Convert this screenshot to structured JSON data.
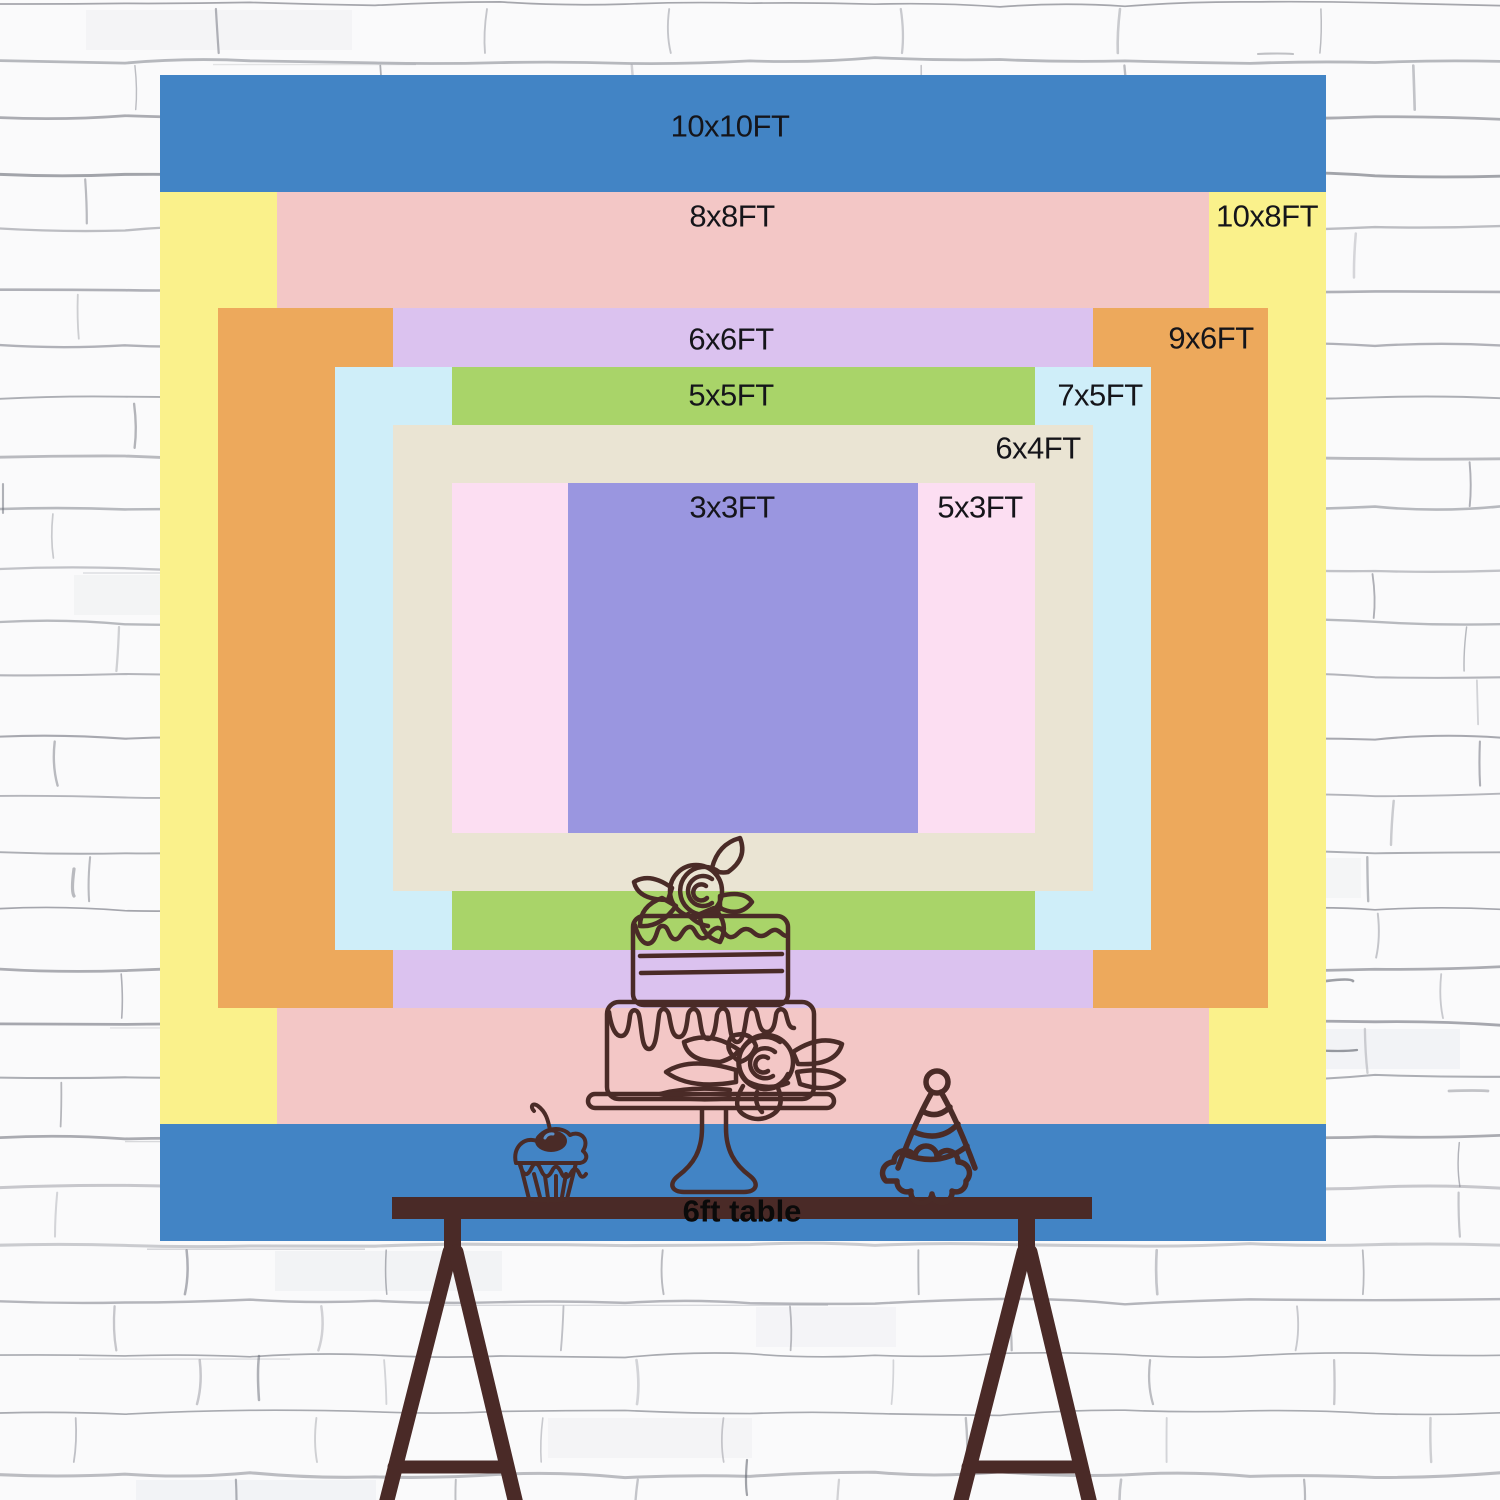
{
  "backdrop_chart": {
    "description_icon": "nested-backdrop-size-rectangles",
    "label_color": "#15151a",
    "sizes": [
      {
        "id": "10x10",
        "label": "10x10FT",
        "width_ft": 10,
        "height_ft": 10,
        "color": "#4284c5"
      },
      {
        "id": "10x8",
        "label": "10x8FT",
        "width_ft": 10,
        "height_ft": 8,
        "color": "#faf18b"
      },
      {
        "id": "8x8",
        "label": "8x8FT",
        "width_ft": 8,
        "height_ft": 8,
        "color": "#f3c7c6"
      },
      {
        "id": "9x6",
        "label": "9x6FT",
        "width_ft": 9,
        "height_ft": 6,
        "color": "#eda95c"
      },
      {
        "id": "6x6",
        "label": "6x6FT",
        "width_ft": 6,
        "height_ft": 6,
        "color": "#dbc2ef"
      },
      {
        "id": "7x5",
        "label": "7x5FT",
        "width_ft": 7,
        "height_ft": 5,
        "color": "#cfeef9"
      },
      {
        "id": "5x5",
        "label": "5x5FT",
        "width_ft": 5,
        "height_ft": 5,
        "color": "#a9d469"
      },
      {
        "id": "6x4",
        "label": "6x4FT",
        "width_ft": 6,
        "height_ft": 4,
        "color": "#eae4d3"
      },
      {
        "id": "5x3",
        "label": "5x3FT",
        "width_ft": 5,
        "height_ft": 3,
        "color": "#fcdef2"
      },
      {
        "id": "3x3",
        "label": "3x3FT",
        "width_ft": 3,
        "height_ft": 3,
        "color": "#9a96e0"
      }
    ]
  },
  "table": {
    "label": "6ft table",
    "length_ft": 6,
    "bar_color": "#4a2a27"
  },
  "illustration": {
    "line_color": "#4a2b27",
    "items": [
      "tiered-cake-icon",
      "rose-icon",
      "cake-stand-icon",
      "cupcake-icon",
      "party-hat-icon",
      "trestle-legs-icon"
    ]
  },
  "wall": {
    "background": "#fafafb",
    "brick_line_color": "#83858e",
    "brick_accent_color": "#5f626c",
    "brick_shade_color": "#e8eaee"
  }
}
